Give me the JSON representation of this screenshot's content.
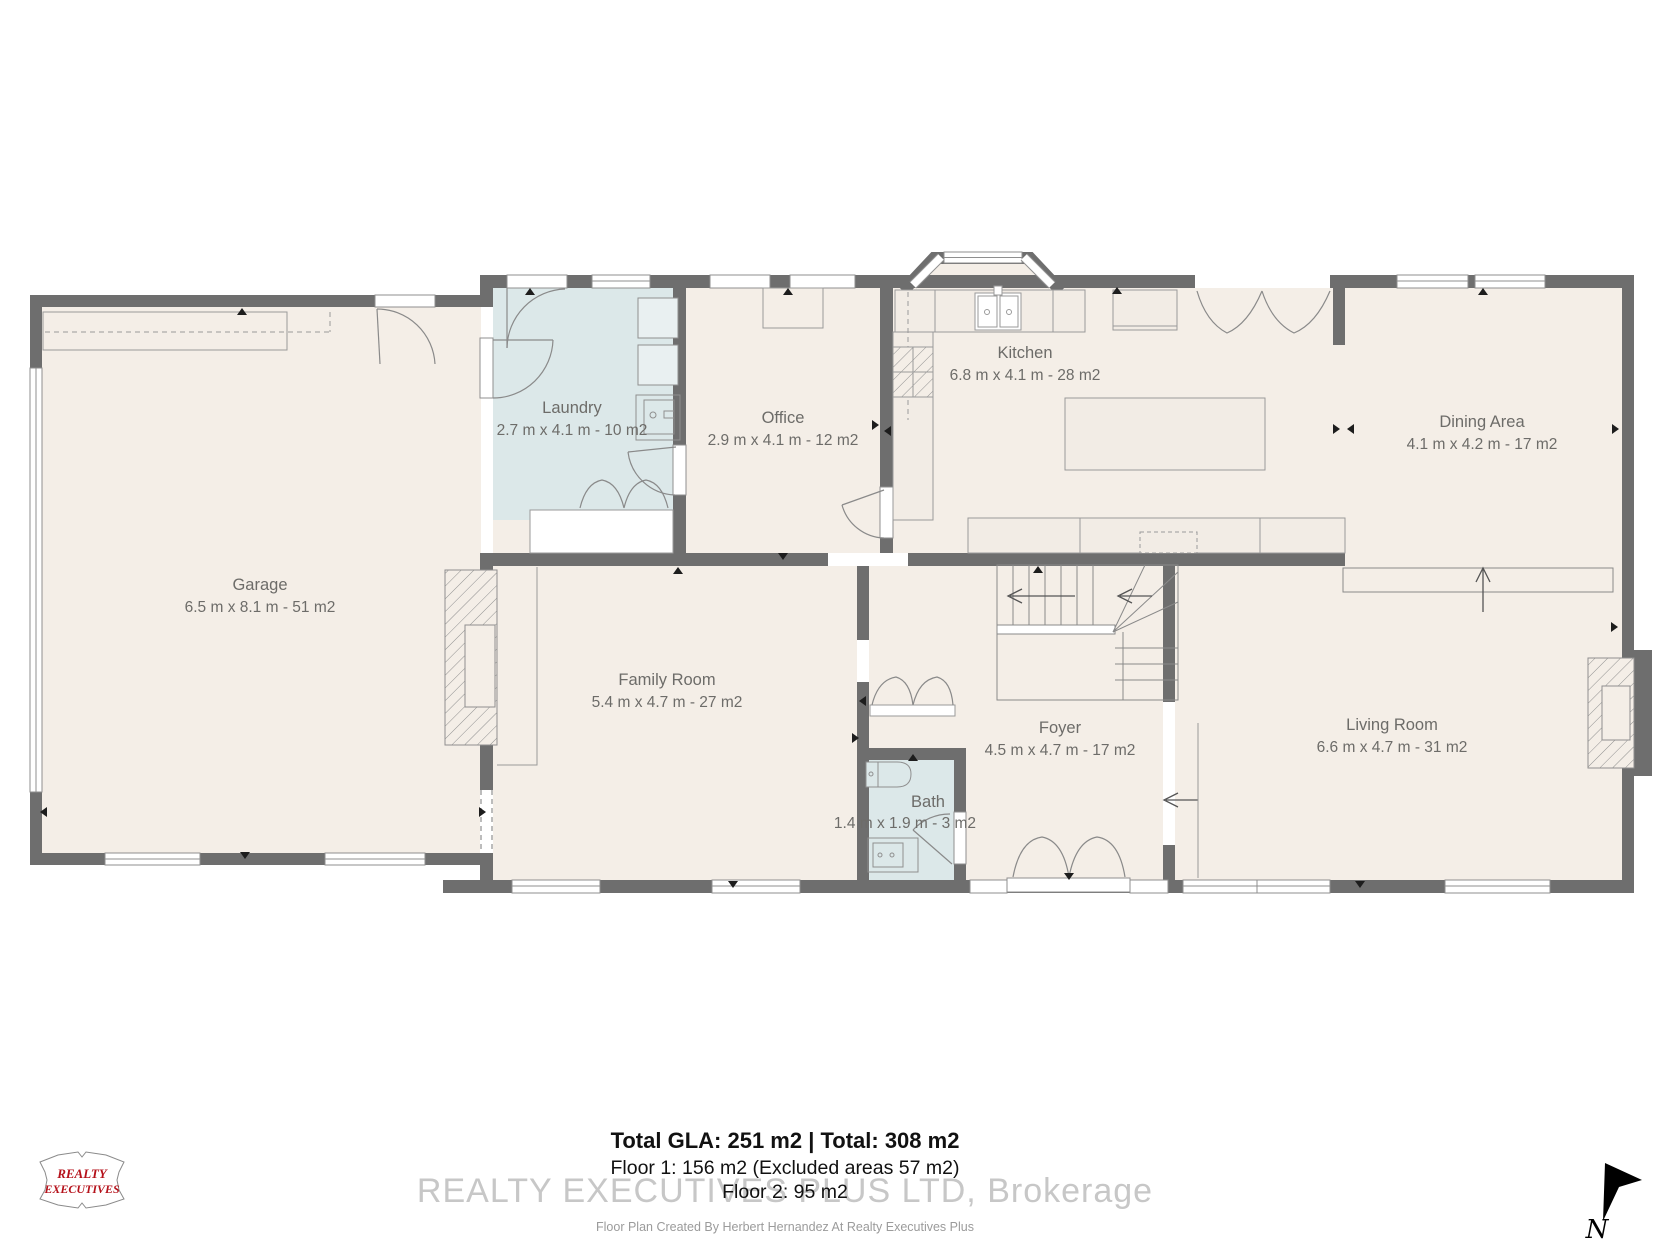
{
  "plan": {
    "rooms": {
      "garage": {
        "name": "Garage",
        "dims": "6.5 m x 8.1 m - 51 m2"
      },
      "laundry": {
        "name": "Laundry",
        "dims": "2.7 m x 4.1 m - 10 m2"
      },
      "office": {
        "name": "Office",
        "dims": "2.9 m x 4.1 m - 12 m2"
      },
      "kitchen": {
        "name": "Kitchen",
        "dims": "6.8 m x 4.1 m - 28 m2"
      },
      "dining": {
        "name": "Dining Area",
        "dims": "4.1 m x 4.2 m - 17 m2"
      },
      "family": {
        "name": "Family Room",
        "dims": "5.4 m x 4.7 m - 27 m2"
      },
      "foyer": {
        "name": "Foyer",
        "dims": "4.5 m x 4.7 m - 17 m2"
      },
      "bath": {
        "name": "Bath",
        "dims": "1.4 m x 1.9 m - 3 m2"
      },
      "living": {
        "name": "Living Room",
        "dims": "6.6 m x 4.7 m - 31 m2"
      }
    },
    "compass_label": "N"
  },
  "summary": {
    "totals": "Total GLA: 251 m2 | Total: 308 m2",
    "floor1": "Floor 1: 156 m2 (Excluded areas 57 m2)",
    "floor2": "Floor 2: 95 m2",
    "watermark": "REALTY EXECUTIVES PLUS LTD, Brokerage",
    "credit": "Floor Plan Created By Herbert Hernandez At Realty Executives Plus"
  },
  "logo": {
    "line1": "REALTY",
    "line2": "EXECUTIVES"
  },
  "colors": {
    "wall": "#6e6e6e",
    "floor": "#f4eee7",
    "wet_room": "#dce8e9",
    "logo_red": "#b5121b",
    "text_gray": "#6d6c69"
  }
}
